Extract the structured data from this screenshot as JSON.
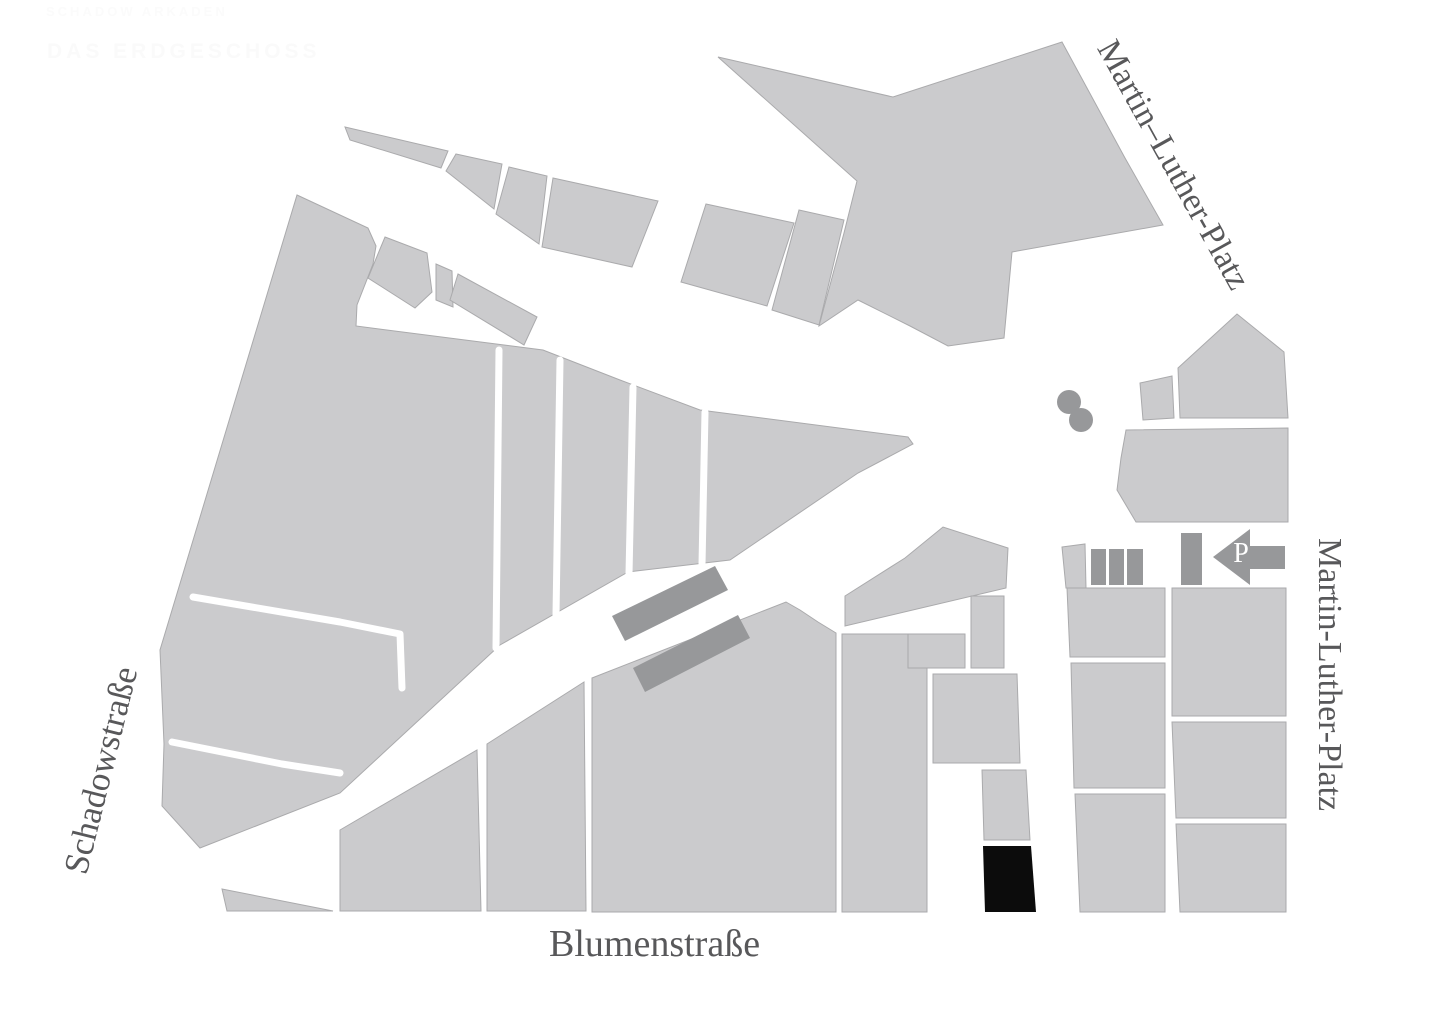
{
  "page": {
    "background": "#ffffff"
  },
  "header": {
    "nav_text": "SCHADOW ARKADEN",
    "title_text": "DAS ERDGESCHOSS",
    "text_color": "#fbfbfb"
  },
  "map": {
    "street_labels": {
      "top_right": "Martin–Luther-Platz",
      "right": "Martin-Luther-Platz",
      "left": "Schadowstraße",
      "bottom": "Blumenstraße"
    },
    "parking": {
      "label": "P",
      "icon": "parking-arrow-left-icon"
    },
    "features": {
      "highlighted_building": "black-building",
      "plaza_markers": "two-gray-dots",
      "platforms": "two-dark-diagonal-buildings"
    },
    "colors": {
      "block": "#cbcbcd",
      "block_outline": "#aaaaac",
      "building_dark": "#97989a",
      "highlight_building": "#0c0c0c",
      "street": "#ffffff",
      "label_text": "#58585a"
    }
  }
}
